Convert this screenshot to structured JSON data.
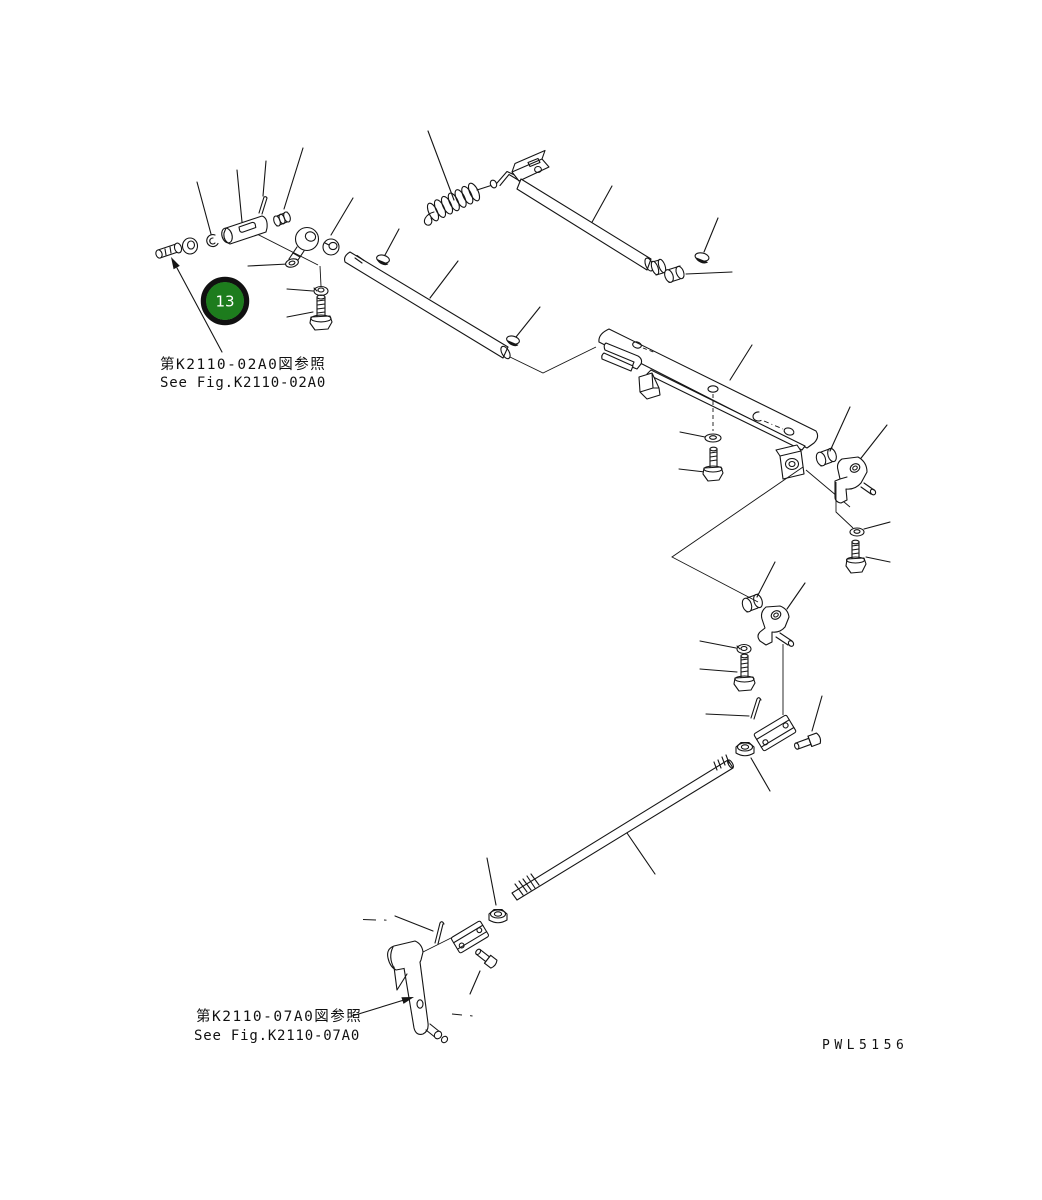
{
  "page": {
    "background_color": "#ffffff",
    "line_color": "#151515"
  },
  "callout": {
    "number": "13",
    "fill_color": "#1d7c1d",
    "ring_color": "#111111",
    "text_color": "#ffffff"
  },
  "references": [
    {
      "jp": "第K2110-02A0図参照",
      "en": "See Fig.K2110-02A0"
    },
    {
      "jp": "第K2110-07A0図参照",
      "en": "See Fig.K2110-07A0"
    }
  ],
  "drawing_code": "PWL5156"
}
